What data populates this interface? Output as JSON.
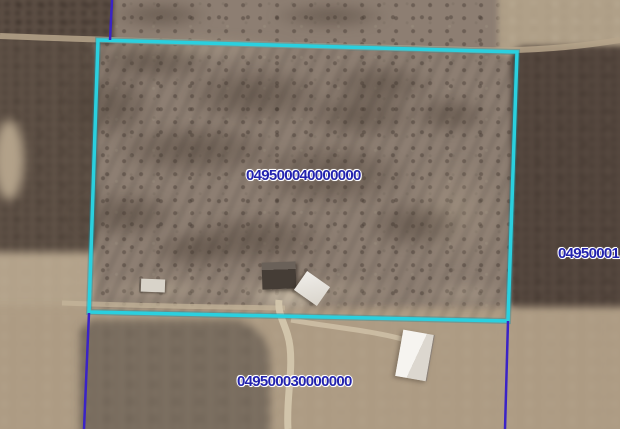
{
  "map": {
    "labels": {
      "parcel_center": "049500040000000",
      "parcel_bottom": "049500030000000",
      "parcel_right_clipped": "04950001"
    },
    "colors": {
      "selected_parcel_outline": "#2ad0df",
      "parcel_line": "#3a23c6",
      "parcel_label_text": "#2323ae",
      "parcel_label_halo": "#ffffff"
    }
  }
}
